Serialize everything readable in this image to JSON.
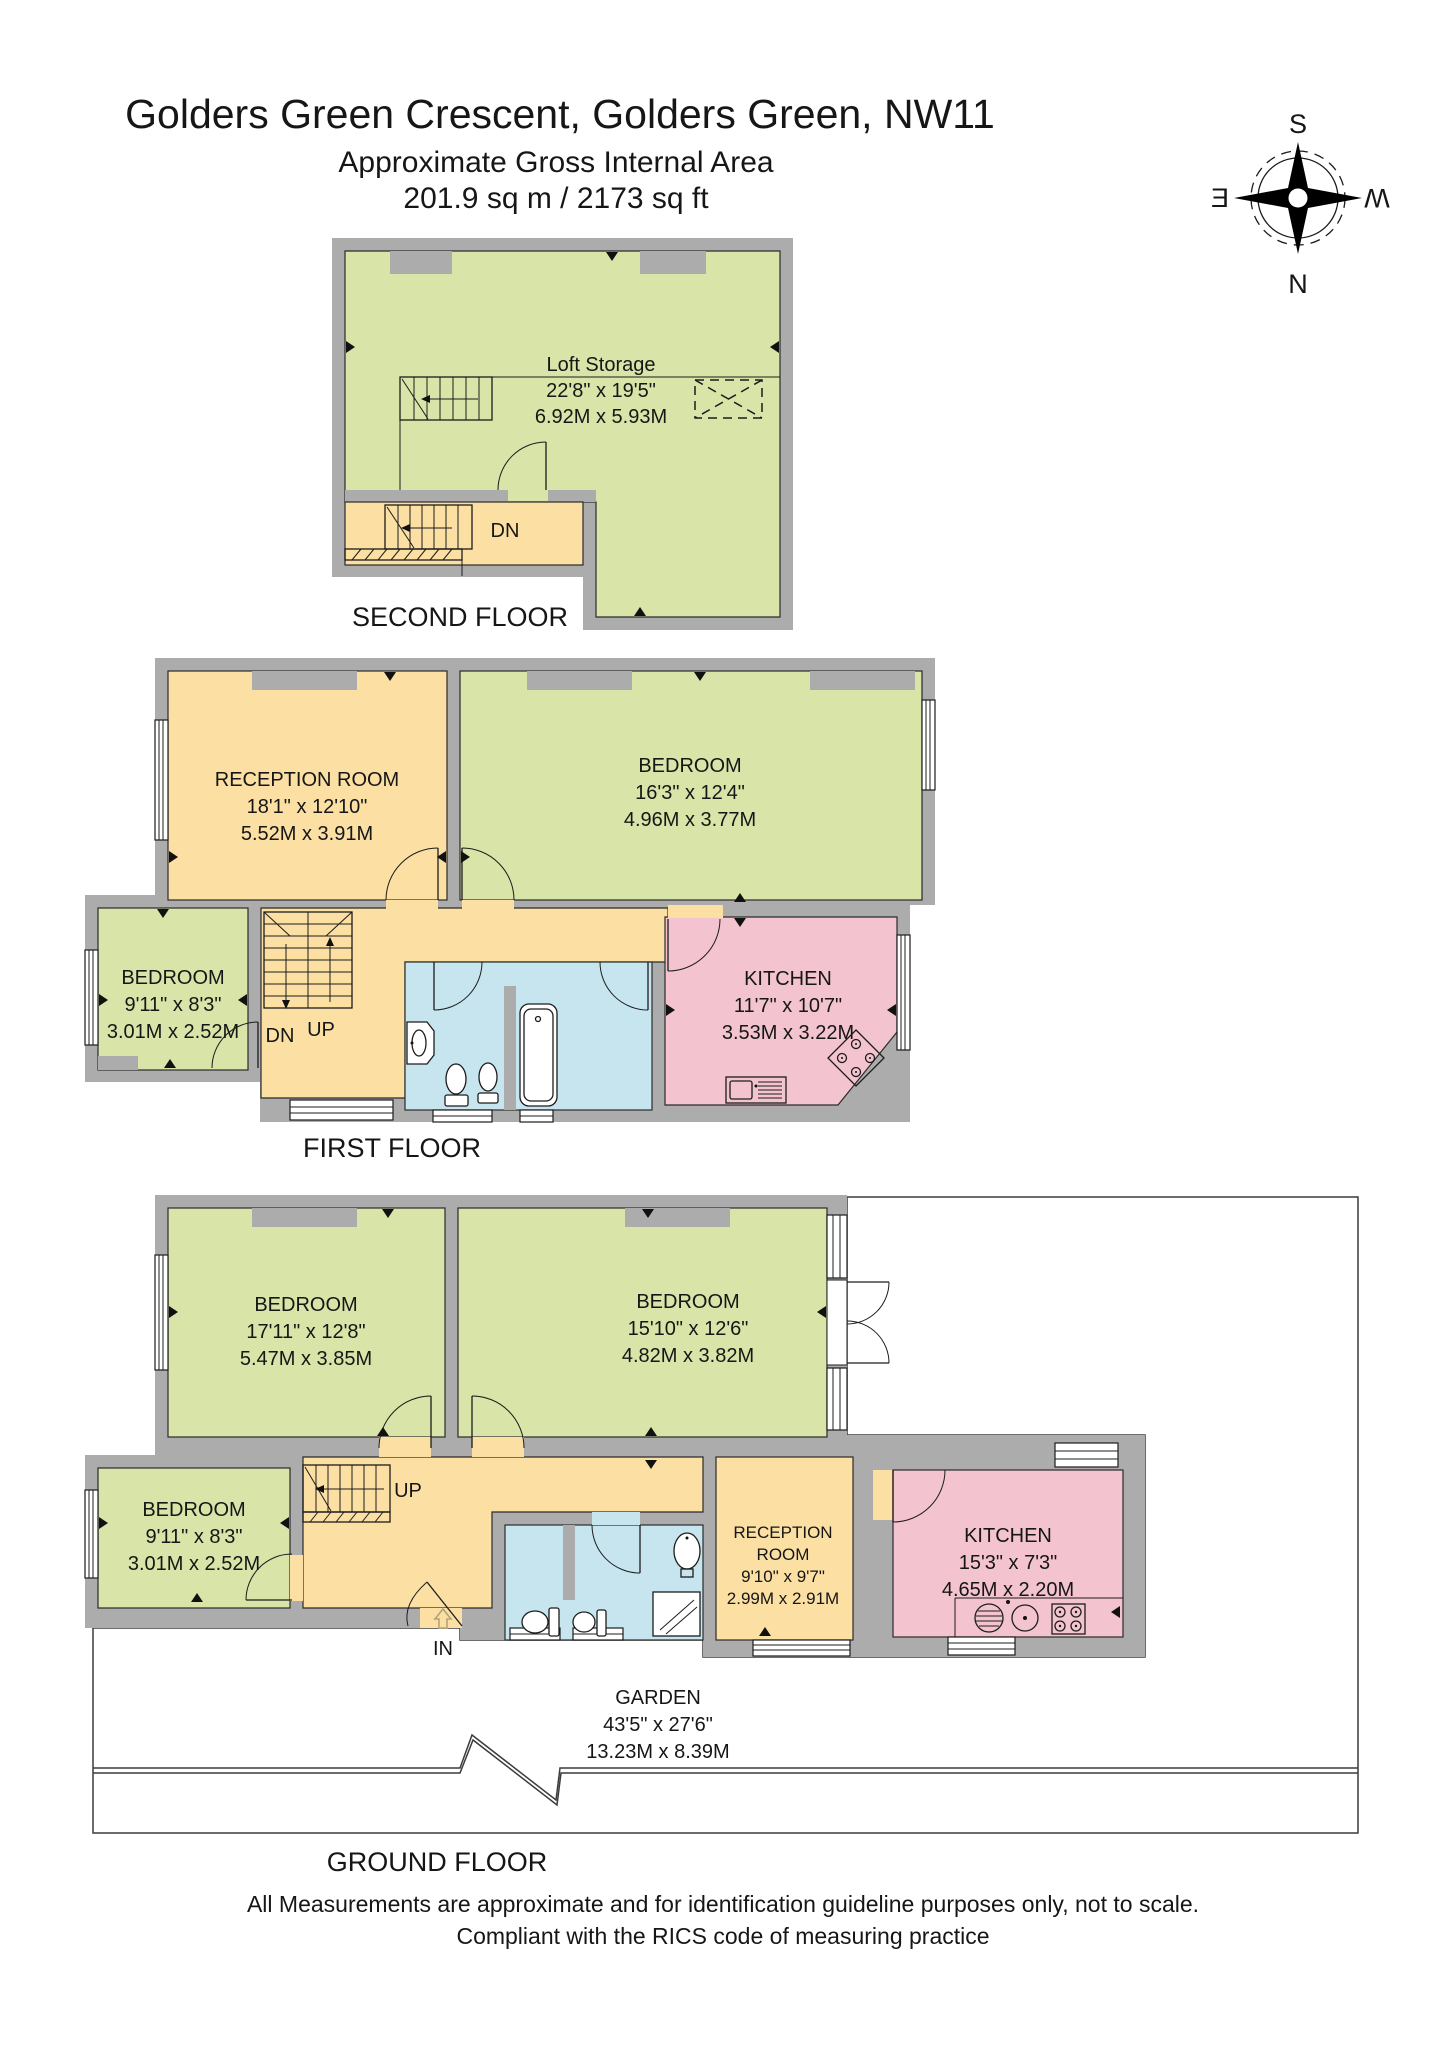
{
  "title": {
    "line1": "Golders Green Crescent, Golders Green, NW11",
    "line2": "Approximate Gross Internal Area",
    "line3": "201.9 sq m / 2173 sq ft"
  },
  "compass": {
    "north": "N",
    "south": "S",
    "east": "E",
    "west": "W"
  },
  "floors": {
    "second": {
      "label": "SECOND FLOOR",
      "loft": {
        "name": "Loft Storage",
        "imperial": "22'8\" x 19'5\"",
        "metric": "6.92M x 5.93M"
      },
      "stair_down": "DN"
    },
    "first": {
      "label": "FIRST FLOOR",
      "reception": {
        "name": "RECEPTION ROOM",
        "imperial": "18'1\" x 12'10\"",
        "metric": "5.52M x 3.91M"
      },
      "bedroom_right": {
        "name": "BEDROOM",
        "imperial": "16'3\" x 12'4\"",
        "metric": "4.96M x 3.77M"
      },
      "bedroom_small": {
        "name": "BEDROOM",
        "imperial": "9'11\" x 8'3\"",
        "metric": "3.01M x 2.52M"
      },
      "kitchen": {
        "name": "KITCHEN",
        "imperial": "11'7\" x 10'7\"",
        "metric": "3.53M x 3.22M"
      },
      "stair_down": "DN",
      "stair_up": "UP"
    },
    "ground": {
      "label": "GROUND FLOOR",
      "bedroom_left": {
        "name": "BEDROOM",
        "imperial": "17'11\" x 12'8\"",
        "metric": "5.47M x 3.85M"
      },
      "bedroom_right": {
        "name": "BEDROOM",
        "imperial": "15'10\" x 12'6\"",
        "metric": "4.82M x 3.82M"
      },
      "bedroom_small": {
        "name": "BEDROOM",
        "imperial": "9'11\" x 8'3\"",
        "metric": "3.01M x 2.52M"
      },
      "reception": {
        "name1": "RECEPTION",
        "name2": "ROOM",
        "imperial": "9'10\" x 9'7\"",
        "metric": "2.99M x 2.91M"
      },
      "kitchen": {
        "name": "KITCHEN",
        "imperial": "15'3\" x 7'3\"",
        "metric": "4.65M x 2.20M"
      },
      "garden": {
        "name": "GARDEN",
        "imperial": "43'5\" x 27'6\"",
        "metric": "13.23M x 8.39M"
      },
      "stair_up": "UP",
      "entrance": "IN"
    }
  },
  "footer": {
    "line1": "All Measurements are approximate and for identification guideline purposes only, not to scale.",
    "line2": "Compliant with the RICS code of measuring practice"
  },
  "colors": {
    "room_green": "#d9e4a9",
    "room_orange": "#fbdfa3",
    "room_pink": "#f3c4cf",
    "room_blue": "#c6e5ef",
    "garden_green": "#d7ebdb",
    "wall_gray": "#acacac"
  }
}
